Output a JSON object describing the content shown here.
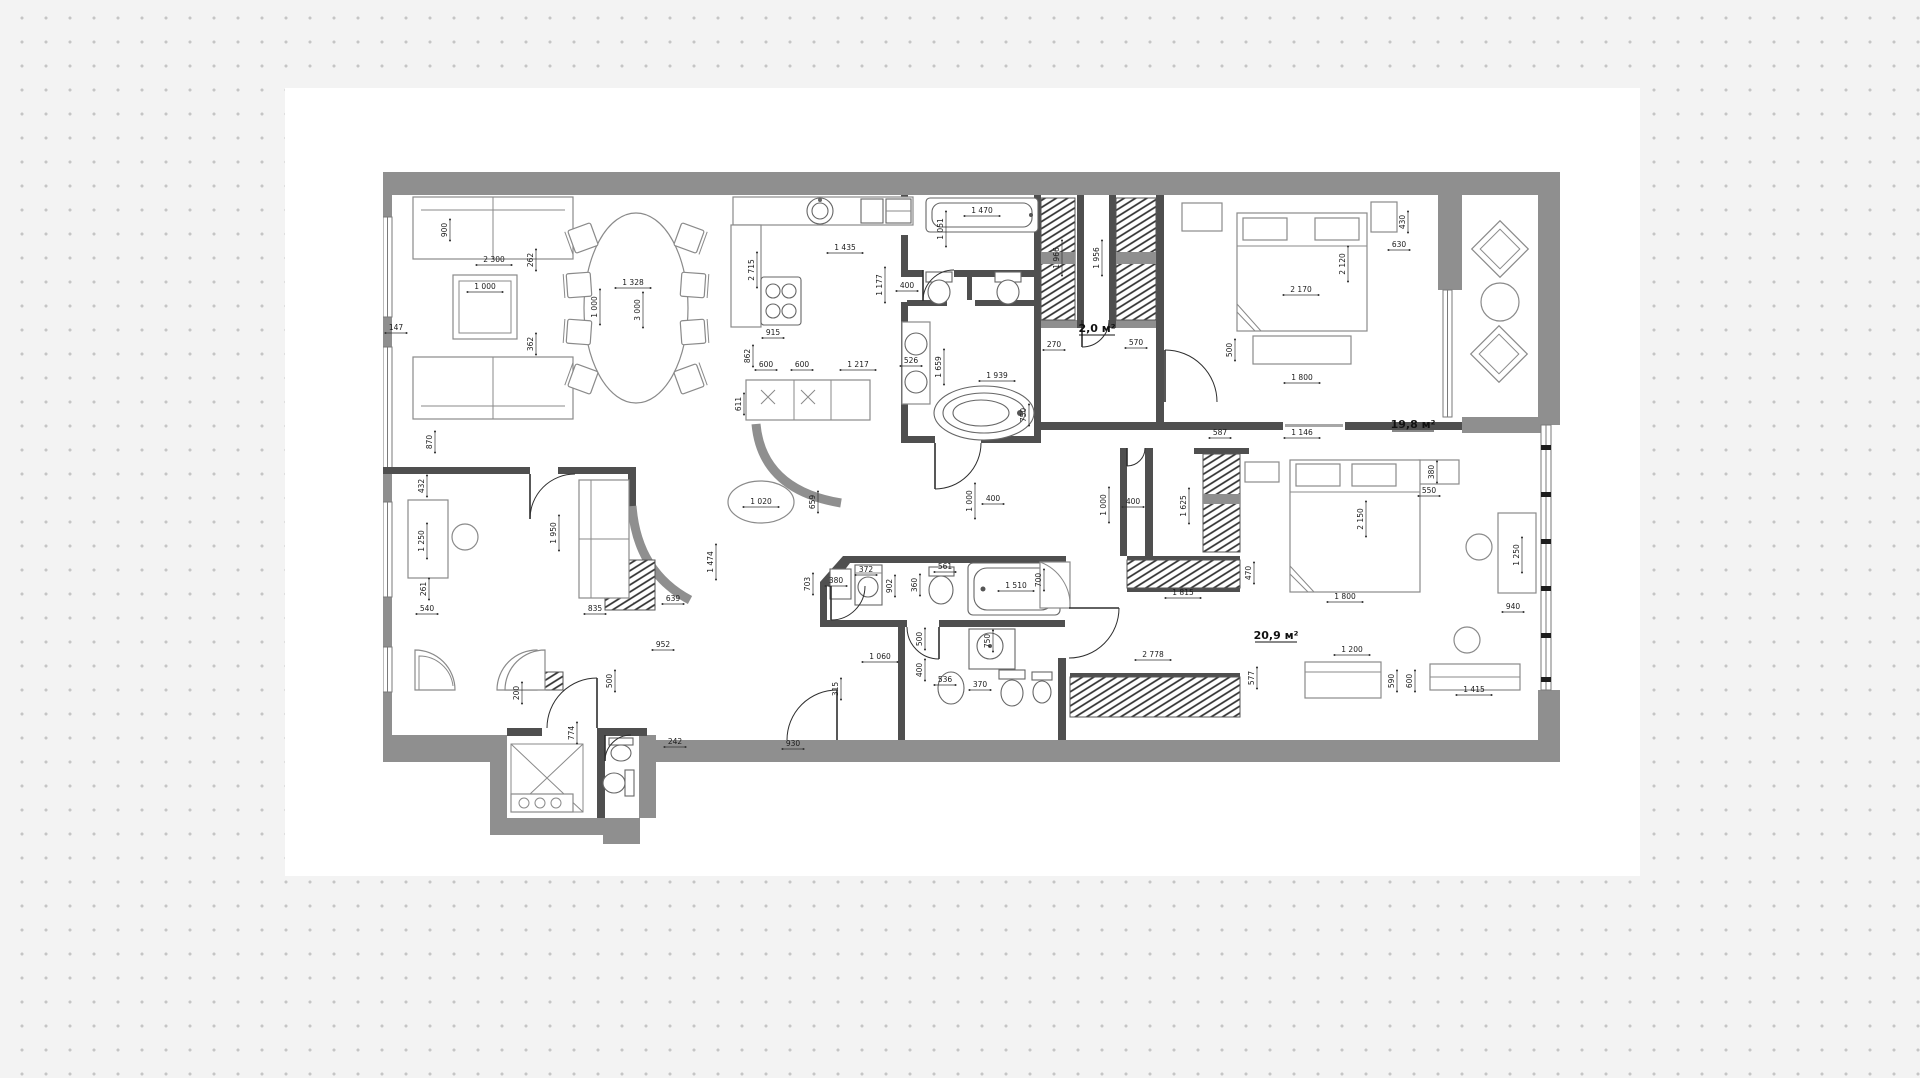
{
  "canvas": {
    "background": "#f3f3f3",
    "dot_color": "#c5c5c5",
    "sheet_color": "#ffffff",
    "accent_wall_color": "#8f8f8f",
    "inner_wall_color": "#4f4f4f"
  },
  "plan": {
    "title": "apartment-floor-plan",
    "area_labels": [
      {
        "text": "2,0 м²",
        "x": 714,
        "y": 160
      },
      {
        "text": "19,8 м²",
        "x": 1030,
        "y": 256
      },
      {
        "text": "20,9 м²",
        "x": 893,
        "y": 467
      }
    ],
    "dimension_labels": [
      {
        "text": "900",
        "x": 64,
        "y": 58,
        "rot": -90
      },
      {
        "text": "2 300",
        "x": 111,
        "y": 90,
        "rot": 0
      },
      {
        "text": "262",
        "x": 150,
        "y": 88,
        "rot": -90
      },
      {
        "text": "1 000",
        "x": 102,
        "y": 117,
        "rot": 0
      },
      {
        "text": "1 000",
        "x": 214,
        "y": 135,
        "rot": -90
      },
      {
        "text": "362",
        "x": 150,
        "y": 172,
        "rot": -90
      },
      {
        "text": "147",
        "x": 13,
        "y": 158,
        "rot": 0
      },
      {
        "text": "870",
        "x": 49,
        "y": 270,
        "rot": -90
      },
      {
        "text": "1 328",
        "x": 250,
        "y": 113,
        "rot": 0
      },
      {
        "text": "3 000",
        "x": 257,
        "y": 138,
        "rot": -90
      },
      {
        "text": "2 715",
        "x": 371,
        "y": 98,
        "rot": -90
      },
      {
        "text": "1 435",
        "x": 462,
        "y": 78,
        "rot": 0
      },
      {
        "text": "1 177",
        "x": 499,
        "y": 113,
        "rot": -90
      },
      {
        "text": "400",
        "x": 524,
        "y": 116,
        "rot": 0
      },
      {
        "text": "915",
        "x": 390,
        "y": 163,
        "rot": 0
      },
      {
        "text": "862",
        "x": 367,
        "y": 184,
        "rot": -90
      },
      {
        "text": "600",
        "x": 383,
        "y": 195,
        "rot": 0
      },
      {
        "text": "600",
        "x": 419,
        "y": 195,
        "rot": 0
      },
      {
        "text": "1 217",
        "x": 475,
        "y": 195,
        "rot": 0
      },
      {
        "text": "611",
        "x": 358,
        "y": 232,
        "rot": -90
      },
      {
        "text": "526",
        "x": 528,
        "y": 191,
        "rot": 0
      },
      {
        "text": "1 659",
        "x": 558,
        "y": 195,
        "rot": -90
      },
      {
        "text": "1 470",
        "x": 599,
        "y": 41,
        "rot": 0
      },
      {
        "text": "1 051",
        "x": 560,
        "y": 57,
        "rot": -90
      },
      {
        "text": "1 939",
        "x": 614,
        "y": 206,
        "rot": 0
      },
      {
        "text": "750",
        "x": 643,
        "y": 243,
        "rot": -90
      },
      {
        "text": "1 966",
        "x": 676,
        "y": 86,
        "rot": -90
      },
      {
        "text": "1 956",
        "x": 716,
        "y": 86,
        "rot": -90
      },
      {
        "text": "270",
        "x": 671,
        "y": 175,
        "rot": 0
      },
      {
        "text": "570",
        "x": 753,
        "y": 173,
        "rot": 0
      },
      {
        "text": "430",
        "x": 1022,
        "y": 50,
        "rot": -90
      },
      {
        "text": "630",
        "x": 1016,
        "y": 75,
        "rot": 0
      },
      {
        "text": "2 170",
        "x": 918,
        "y": 120,
        "rot": 0
      },
      {
        "text": "2 120",
        "x": 962,
        "y": 92,
        "rot": -90
      },
      {
        "text": "500",
        "x": 849,
        "y": 178,
        "rot": -90
      },
      {
        "text": "1 800",
        "x": 919,
        "y": 208,
        "rot": 0
      },
      {
        "text": "587",
        "x": 837,
        "y": 263,
        "rot": 0
      },
      {
        "text": "1 146",
        "x": 919,
        "y": 263,
        "rot": 0
      },
      {
        "text": "380",
        "x": 1051,
        "y": 300,
        "rot": -90
      },
      {
        "text": "550",
        "x": 1046,
        "y": 321,
        "rot": 0
      },
      {
        "text": "2 150",
        "x": 980,
        "y": 347,
        "rot": -90
      },
      {
        "text": "1 800",
        "x": 962,
        "y": 427,
        "rot": 0
      },
      {
        "text": "1 250",
        "x": 1136,
        "y": 383,
        "rot": -90
      },
      {
        "text": "940",
        "x": 1130,
        "y": 437,
        "rot": 0
      },
      {
        "text": "1 415",
        "x": 1091,
        "y": 520,
        "rot": 0
      },
      {
        "text": "590",
        "x": 1011,
        "y": 509,
        "rot": -90
      },
      {
        "text": "600",
        "x": 1029,
        "y": 509,
        "rot": -90
      },
      {
        "text": "1 200",
        "x": 969,
        "y": 480,
        "rot": 0
      },
      {
        "text": "577",
        "x": 871,
        "y": 506,
        "rot": -90
      },
      {
        "text": "2 778",
        "x": 770,
        "y": 485,
        "rot": 0
      },
      {
        "text": "1 815",
        "x": 800,
        "y": 423,
        "rot": 0
      },
      {
        "text": "470",
        "x": 868,
        "y": 401,
        "rot": -90
      },
      {
        "text": "1 625",
        "x": 803,
        "y": 334,
        "rot": -90
      },
      {
        "text": "400",
        "x": 750,
        "y": 332,
        "rot": 0
      },
      {
        "text": "1 000",
        "x": 723,
        "y": 333,
        "rot": -90
      },
      {
        "text": "1 000",
        "x": 589,
        "y": 329,
        "rot": -90
      },
      {
        "text": "400",
        "x": 610,
        "y": 329,
        "rot": 0
      },
      {
        "text": "703",
        "x": 427,
        "y": 412,
        "rot": -90
      },
      {
        "text": "380",
        "x": 453,
        "y": 411,
        "rot": 0
      },
      {
        "text": "372",
        "x": 483,
        "y": 400,
        "rot": 0
      },
      {
        "text": "902",
        "x": 509,
        "y": 414,
        "rot": -90
      },
      {
        "text": "360",
        "x": 534,
        "y": 413,
        "rot": -90
      },
      {
        "text": "561",
        "x": 562,
        "y": 397,
        "rot": 0
      },
      {
        "text": "1 510",
        "x": 633,
        "y": 416,
        "rot": 0
      },
      {
        "text": "700",
        "x": 658,
        "y": 408,
        "rot": -90
      },
      {
        "text": "500",
        "x": 539,
        "y": 467,
        "rot": -90
      },
      {
        "text": "1 060",
        "x": 497,
        "y": 487,
        "rot": 0
      },
      {
        "text": "400",
        "x": 539,
        "y": 498,
        "rot": -90
      },
      {
        "text": "536",
        "x": 562,
        "y": 510,
        "rot": 0
      },
      {
        "text": "750",
        "x": 607,
        "y": 469,
        "rot": -90
      },
      {
        "text": "370",
        "x": 597,
        "y": 515,
        "rot": 0
      },
      {
        "text": "315",
        "x": 455,
        "y": 517,
        "rot": -90
      },
      {
        "text": "1 020",
        "x": 378,
        "y": 332,
        "rot": 0
      },
      {
        "text": "659",
        "x": 432,
        "y": 330,
        "rot": -90
      },
      {
        "text": "1 474",
        "x": 330,
        "y": 390,
        "rot": -90
      },
      {
        "text": "432",
        "x": 41,
        "y": 314,
        "rot": -90
      },
      {
        "text": "1 250",
        "x": 41,
        "y": 369,
        "rot": -90
      },
      {
        "text": "261",
        "x": 43,
        "y": 417,
        "rot": -90
      },
      {
        "text": "540",
        "x": 44,
        "y": 439,
        "rot": 0
      },
      {
        "text": "1 950",
        "x": 173,
        "y": 361,
        "rot": -90
      },
      {
        "text": "835",
        "x": 212,
        "y": 439,
        "rot": 0
      },
      {
        "text": "639",
        "x": 290,
        "y": 429,
        "rot": 0
      },
      {
        "text": "952",
        "x": 280,
        "y": 475,
        "rot": 0
      },
      {
        "text": "500",
        "x": 229,
        "y": 509,
        "rot": -90
      },
      {
        "text": "200",
        "x": 136,
        "y": 521,
        "rot": -90
      },
      {
        "text": "774",
        "x": 191,
        "y": 561,
        "rot": -90
      },
      {
        "text": "242",
        "x": 292,
        "y": 572,
        "rot": 0
      },
      {
        "text": "930",
        "x": 410,
        "y": 574,
        "rot": 0
      }
    ]
  }
}
